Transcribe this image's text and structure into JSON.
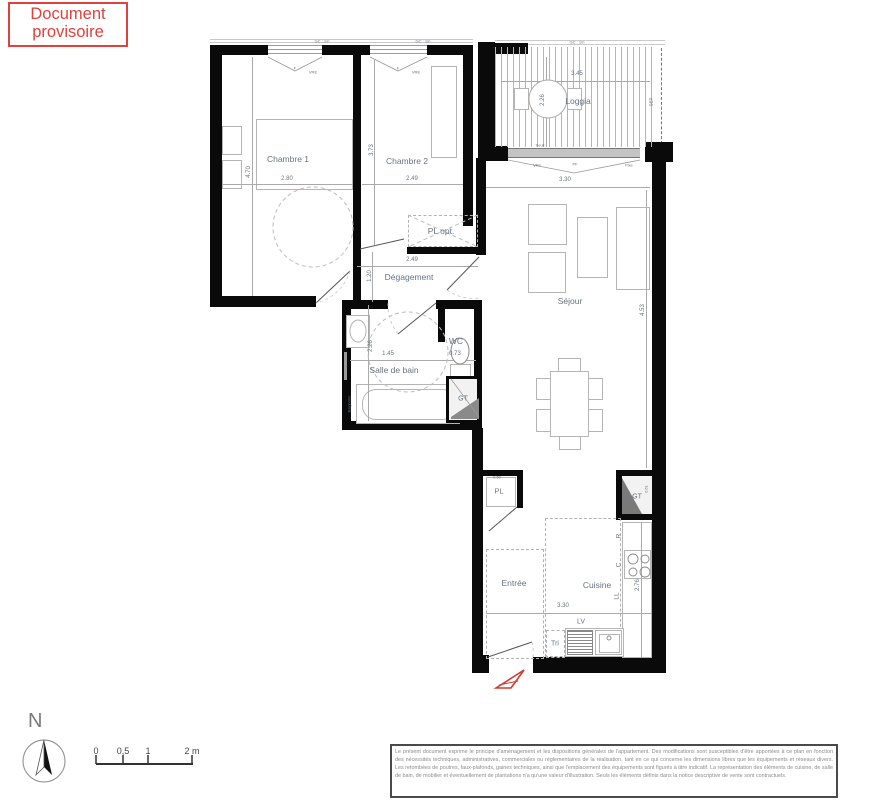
{
  "stamp": {
    "line1": "Document",
    "line2": "provisoire"
  },
  "colors": {
    "stamp_red": "#e2403c",
    "wall_black": "#0a0a0a",
    "label_gray_blue": "#68737f",
    "thin_line": "#a9a9a9",
    "entry_arrow_red": "#d03a33"
  },
  "plan": {
    "rooms": {
      "chambre1": "Chambre 1",
      "chambre2": "Chambre 2",
      "loggia": "Loggia",
      "sejour": "Séjour",
      "degagement": "Dégagement",
      "salle_de_bain": "Salle de bain",
      "wc": "WC",
      "entree": "Entrée",
      "cuisine": "Cuisine"
    },
    "dimensions": {
      "chambre1_w": "2.80",
      "chambre1_h": "4.70",
      "chambre2_w": "2.49",
      "chambre2_h": "3.73",
      "loggia_w": "3.45",
      "loggia_h": "2.26",
      "sejour_w": "3.30",
      "sejour_h": "4.53",
      "degagement_w": "2.49",
      "degagement_h": "1.20",
      "sdb_w": "1.45",
      "sdb_h": "2.26",
      "wc_w": "0.73",
      "cuisine_w": "3.30",
      "cuisine_h": "2.76",
      "pl_w": "0.60",
      "gt_cuisine_h": "0.61"
    },
    "tags": {
      "pl_opt": "PL opt.",
      "pl": "PL",
      "gt": "GT",
      "sep": "SEP",
      "seuil": "Seuil",
      "gc": "GC : 1m",
      "f": "F",
      "vre": "VRE",
      "vre2": "VRe",
      "pf": "PF",
      "fixe": "Fixe",
      "baignoire": "Baignoire",
      "lv": "LV",
      "tri": "Tri",
      "r": "R",
      "c": "C",
      "ll": "LL"
    }
  },
  "legend": {
    "north": "N",
    "scale": {
      "t0": "0",
      "t05": "0,5",
      "t1": "1",
      "t2": "2 m"
    }
  },
  "disclaimer": "Le présent document exprime le principe d'aménagement et les dispositions générales de l'appartement. Des modifications sont susceptibles d'être apportées à ce plan en fonction des nécessités techniques, administratives, commerciales ou réglementaires de la réalisation, tant en ce qui concerne les dimensions libres que les équipements et réseaux divers. Les retombées de poutres, faux-plafonds, gaines techniques, ainsi que l'emplacement des équipements sont figurés à titre indicatif. La représentation des éléments de cuisine, de salle de bain, de mobilier et éventuellement de plantations n'a qu'une valeur d'illustration. Seuls les éléments définis dans la notice descriptive de vente sont contractuels."
}
